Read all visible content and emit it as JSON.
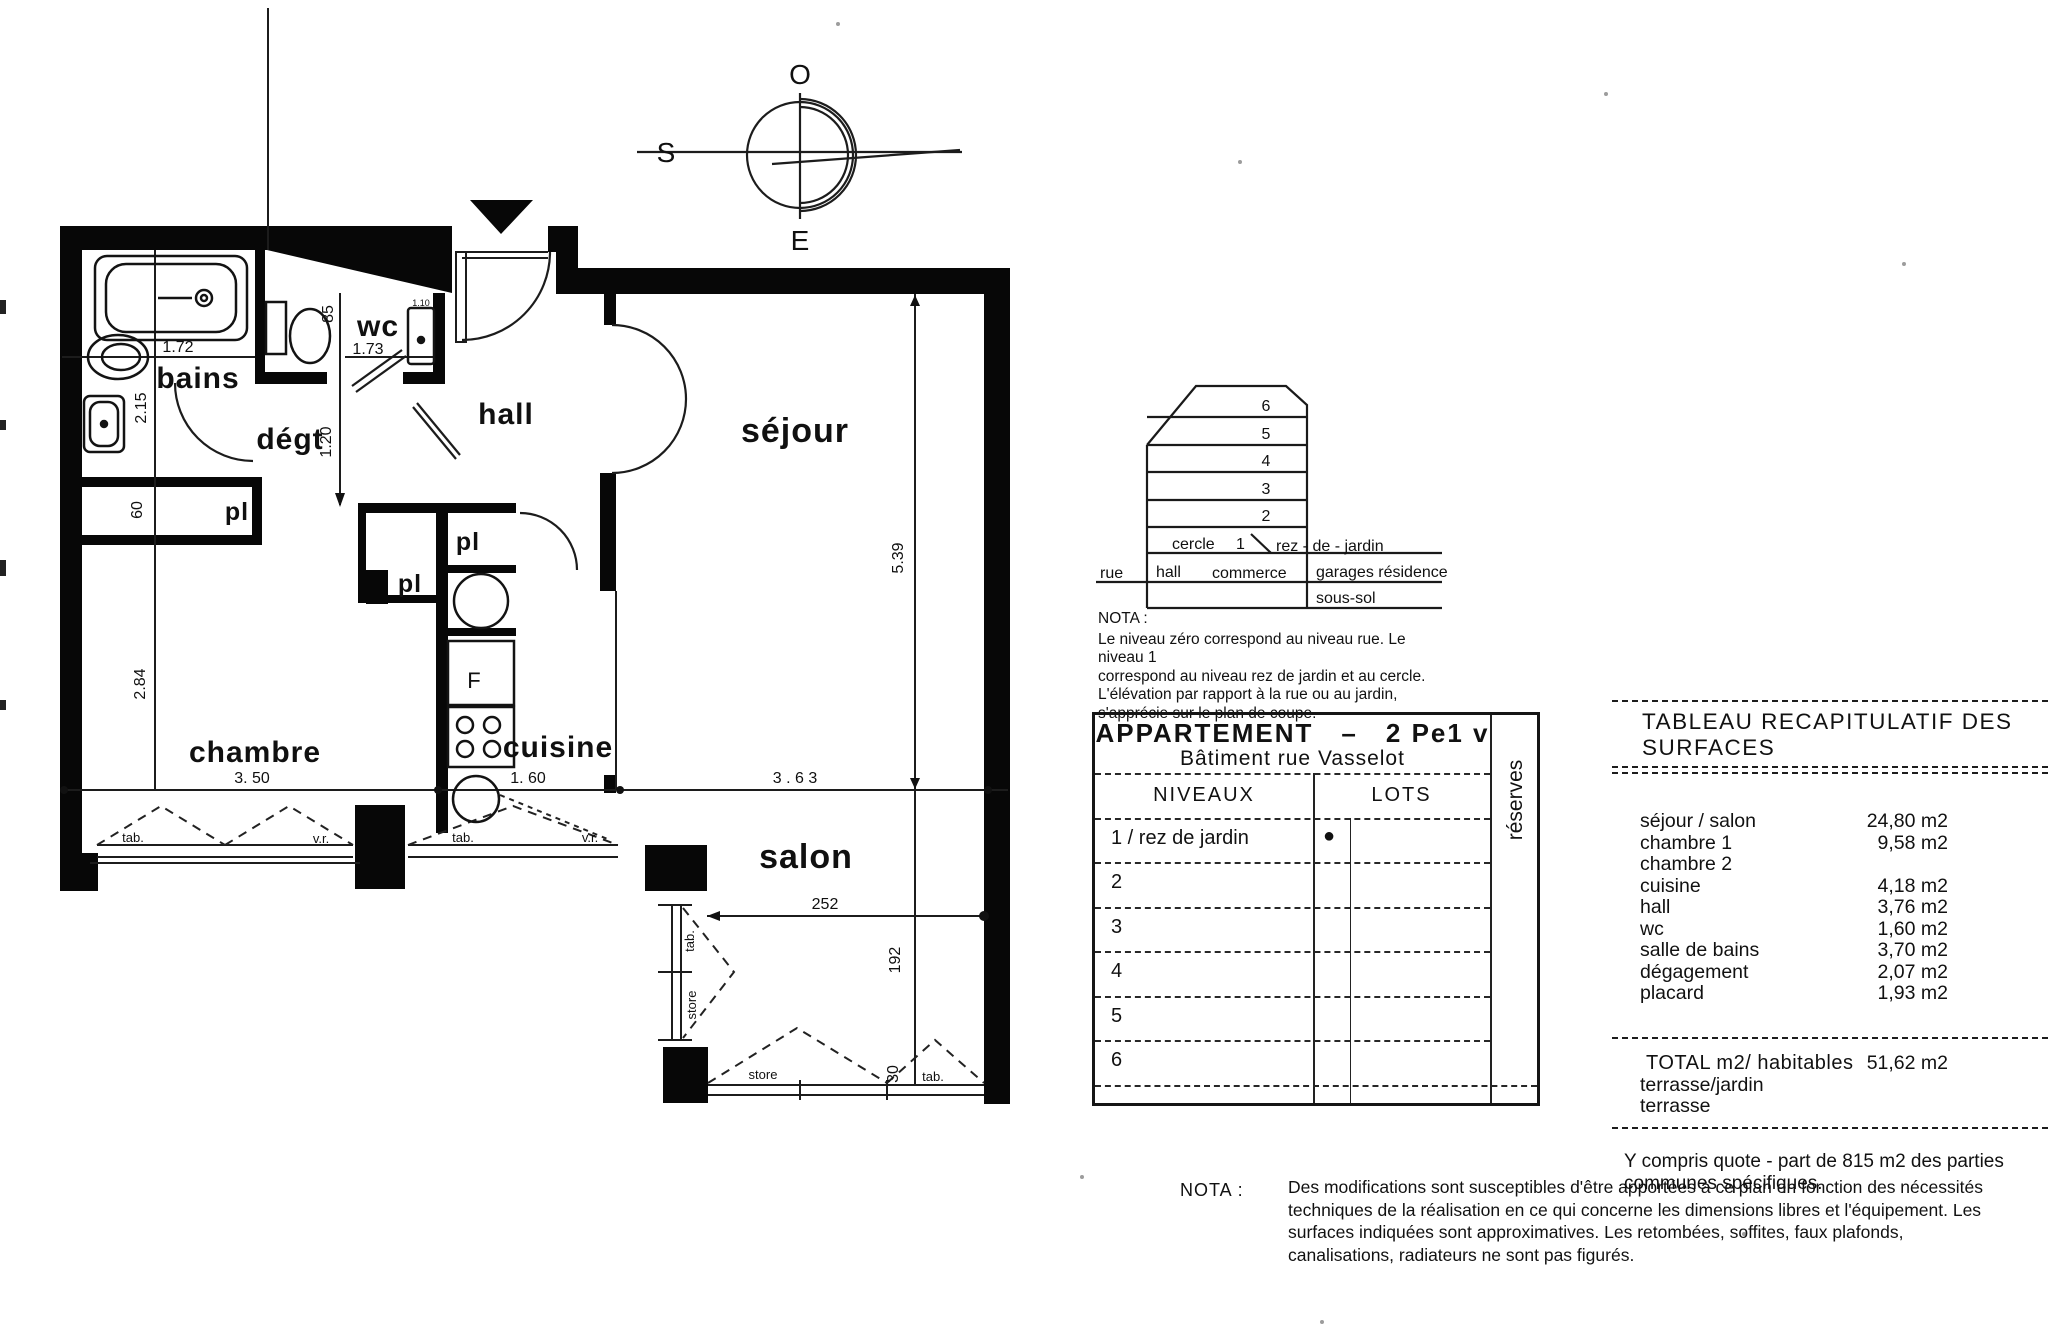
{
  "compass": {
    "top": "O",
    "left": "S",
    "bottom": "E"
  },
  "plan": {
    "rooms": {
      "bains": "bains",
      "wc": "wc",
      "hall": "hall",
      "sejour": "séjour",
      "degt": "dégt",
      "pl_left": "pl",
      "pl_mid": "pl",
      "pl_top": "pl",
      "chambre": "chambre",
      "cuisine": "cuisine",
      "salon": "salon",
      "fridge": "F"
    },
    "dims": {
      "d172": "1.72",
      "d215": "2.15",
      "d85": "85",
      "d173": "1.73",
      "d110": "1.10",
      "d120": "1.20",
      "d60": "60",
      "d284": "2.84",
      "d350": "3. 50",
      "d160": "1. 60",
      "d363": "3 . 6 3",
      "d539": "5.39",
      "d252": "252",
      "d192": "192",
      "d30": "30"
    },
    "openings": {
      "ch_tab": "tab.",
      "ch_vr": "v.r.",
      "cu_tab": "tab.",
      "cu_vr": "v.r.",
      "bay_tab": "tab.",
      "bay_store": "store",
      "bot_store": "store",
      "bot_tab": "tab."
    }
  },
  "section": {
    "floors": [
      "6",
      "5",
      "4",
      "3",
      "2"
    ],
    "cercle": "cercle",
    "one": "1",
    "rez": "rez - de - jardin",
    "rue": "rue",
    "hall": "hall",
    "commerce": "commerce",
    "garages": "garages  résidence",
    "sous_sol": "sous-sol",
    "nota_title": "NOTA :",
    "nota_lines": [
      "Le niveau zéro correspond au niveau rue. Le niveau 1",
      "correspond au niveau  rez de jardin et au cercle.",
      "L'élévation par rapport à la rue ou au jardin,",
      "s'apprécie sur le plan de coupe."
    ]
  },
  "apt_table": {
    "title": "APPARTEMENT",
    "dash": "–",
    "unit": "2 Pe1 v",
    "subtitle": "Bâtiment rue Vasselot",
    "col_niveaux": "NIVEAUX",
    "col_lots": "LOTS",
    "col_reserves": "réserves",
    "rows": [
      {
        "label": "1 / rez de jardin",
        "dot": "●"
      },
      {
        "label": "2"
      },
      {
        "label": "3"
      },
      {
        "label": "4"
      },
      {
        "label": "5"
      },
      {
        "label": "6"
      }
    ]
  },
  "surfaces": {
    "title": "TABLEAU RECAPITULATIF DES SURFACES",
    "rows": [
      {
        "label": "séjour  /  salon",
        "value": "24,80 m2"
      },
      {
        "label": "chambre 1",
        "value": "9,58 m2"
      },
      {
        "label": "chambre 2",
        "value": ""
      },
      {
        "label": "cuisine",
        "value": "4,18 m2"
      },
      {
        "label": "hall",
        "value": "3,76 m2"
      },
      {
        "label": "wc",
        "value": "1,60 m2"
      },
      {
        "label": "salle de bains",
        "value": "3,70 m2"
      },
      {
        "label": "dégagement",
        "value": "2,07 m2"
      },
      {
        "label": "placard",
        "value": "1,93 m2"
      }
    ],
    "total_label": "TOTAL m2/ habitables",
    "total_value": "51,62 m2",
    "extra": [
      "terrasse/jardin",
      "terrasse"
    ],
    "footnote": [
      "Y compris quote - part de 815 m2 des parties",
      "communes spécifiques."
    ]
  },
  "nota": {
    "title": "NOTA :",
    "lines": [
      "Des modifications sont susceptibles d'être apportées à  ce plan en fonction des nécessités",
      "techniques de la réalisation en ce qui concerne  les dimensions libres et l'équipement. Les",
      "surfaces indiquées sont approximatives. Les retombées, soffites, faux plafonds,",
      "canalisations, radiateurs ne sont pas figurés."
    ]
  }
}
